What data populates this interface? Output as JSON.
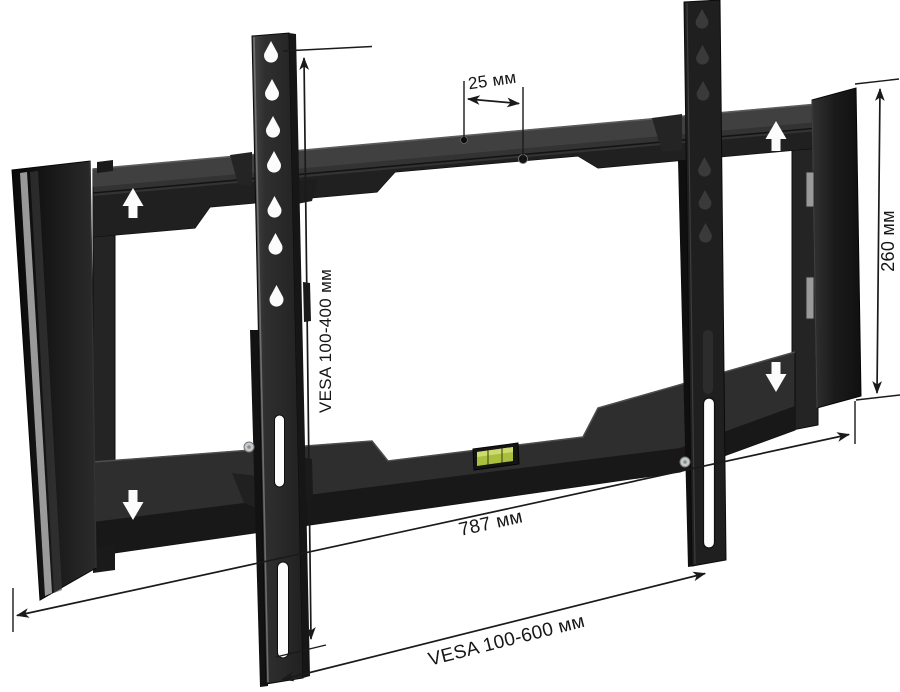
{
  "page": {
    "title": "TV wall mount — VESA dimensions diagram",
    "background": "#ffffff"
  },
  "colors": {
    "ink": "#1a1a1a",
    "metal_face": "#2f2f2f",
    "metal_shadow": "#1a1a1a",
    "cap_black": "#161616",
    "edge_highlight": "#b2b2b2",
    "cutout_white": "#fcfcfc",
    "level_green": "#aabf3e",
    "level_highlight": "#e2ecA0",
    "screw_gray": "#c6cacd"
  },
  "dimensions": {
    "hole_spacing": {
      "label": "25 мм"
    },
    "vesa_vertical": {
      "label": "VESA 100-400 мм"
    },
    "height": {
      "label": "260 мм"
    },
    "width": {
      "label": "787 мм"
    },
    "vesa_horizontal": {
      "label": "VESA 100-600 мм"
    }
  }
}
